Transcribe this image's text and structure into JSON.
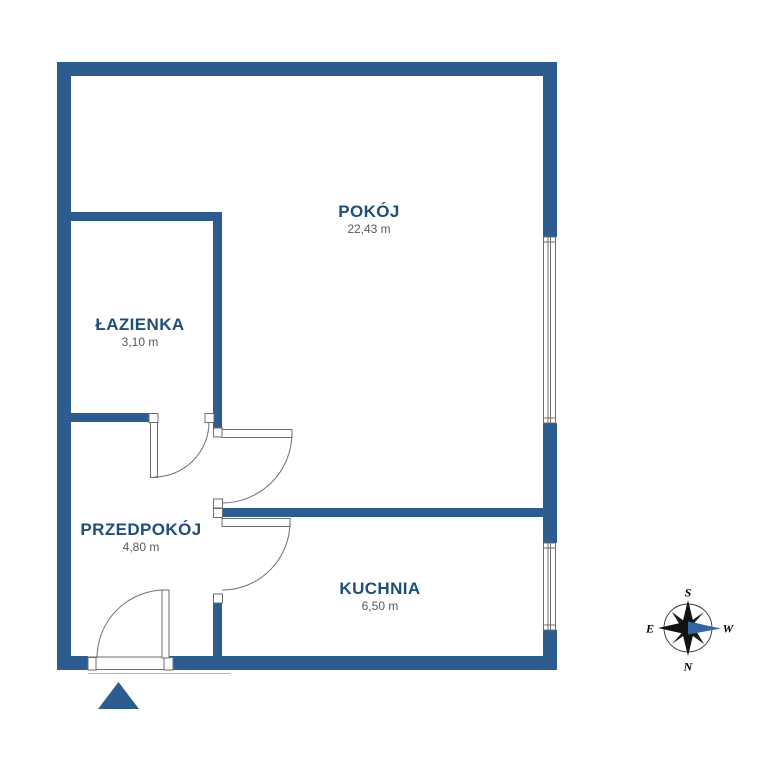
{
  "rooms": [
    {
      "id": "pokoj",
      "name": "POKÓJ",
      "area": "22,43 m"
    },
    {
      "id": "lazienka",
      "name": "ŁAZIENKA",
      "area": "3,10 m"
    },
    {
      "id": "przedpokoj",
      "name": "PRZEDPOKÓJ",
      "area": "4,80 m"
    },
    {
      "id": "kuchnia",
      "name": "KUCHNIA",
      "area": "6,50 m"
    }
  ],
  "compass": {
    "north": "N",
    "south": "S",
    "east": "E",
    "west": "W"
  },
  "colors": {
    "wall": "#2e5c8e",
    "room_label": "#1f4e79",
    "area_text": "#595959",
    "line": "#6e6e6e",
    "compass_highlight": "#3465a4"
  }
}
